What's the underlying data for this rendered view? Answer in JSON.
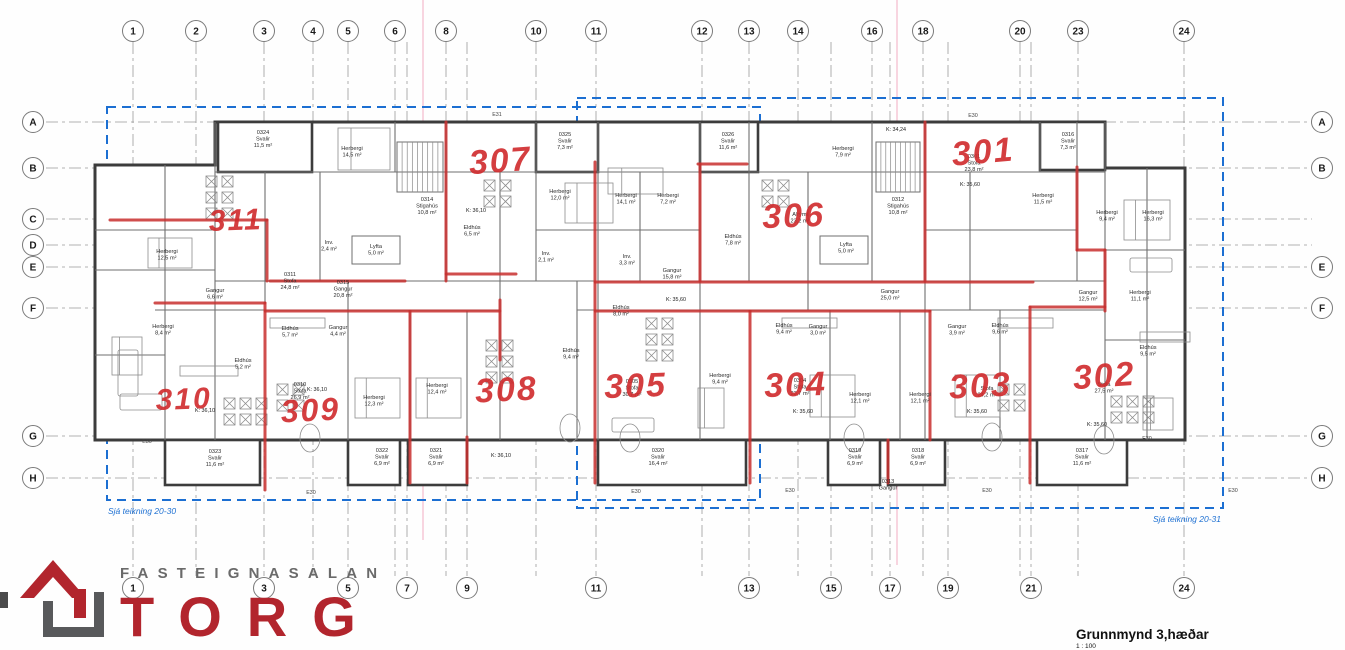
{
  "title_block": {
    "title": "Grunnmynd 3,hæðar",
    "scale": "1 : 100"
  },
  "logo": {
    "word_top": "FASTEIGNASALAN",
    "word_main": "TORG",
    "accent_color": "#b2252d",
    "gray_color": "#58595b"
  },
  "annotations": {
    "left_note": "Sjá teikning 20-30",
    "right_note": "Sjá teikning 20-31",
    "blue_color": "#1c6fd2",
    "rects": [
      {
        "x": 107,
        "y": 107,
        "w": 653,
        "h": 393
      },
      {
        "x": 577,
        "y": 98,
        "w": 646,
        "h": 410
      }
    ]
  },
  "grid": {
    "columns": [
      {
        "x": 133,
        "top": "1",
        "bottom": "1"
      },
      {
        "x": 196,
        "top": "2"
      },
      {
        "x": 264,
        "top": "3",
        "bottom": "3"
      },
      {
        "x": 313,
        "top": "4"
      },
      {
        "x": 348,
        "top": "5",
        "bottom": "5"
      },
      {
        "x": 395,
        "top": "6"
      },
      {
        "x": 407,
        "bottom": "7"
      },
      {
        "x": 446,
        "top": "8"
      },
      {
        "x": 467,
        "bottom": "9"
      },
      {
        "x": 536,
        "top": "10"
      },
      {
        "x": 596,
        "top": "11",
        "bottom": "11"
      },
      {
        "x": 702,
        "top": "12"
      },
      {
        "x": 749,
        "top": "13",
        "bottom": "13"
      },
      {
        "x": 798,
        "top": "14"
      },
      {
        "x": 831,
        "bottom": "15"
      },
      {
        "x": 872,
        "top": "16"
      },
      {
        "x": 890,
        "bottom": "17"
      },
      {
        "x": 923,
        "top": "18"
      },
      {
        "x": 948,
        "bottom": "19"
      },
      {
        "x": 1020,
        "top": "20"
      },
      {
        "x": 1031,
        "bottom": "21"
      },
      {
        "x": 1078,
        "top": "23"
      },
      {
        "x": 1184,
        "top": "24",
        "bottom": "24"
      }
    ],
    "rows": [
      {
        "y": 122,
        "left": "A",
        "right": "A"
      },
      {
        "y": 168,
        "left": "B",
        "right": "B"
      },
      {
        "y": 219,
        "left": "C"
      },
      {
        "y": 245,
        "left": "D"
      },
      {
        "y": 267,
        "left": "E",
        "right": "E"
      },
      {
        "y": 308,
        "left": "F",
        "right": "F"
      },
      {
        "y": 436,
        "left": "G",
        "right": "G"
      },
      {
        "y": 478,
        "left": "H",
        "right": "H"
      }
    ]
  },
  "apartments": [
    {
      "number": "311",
      "x": 236,
      "y": 230,
      "size": 30,
      "rot": -2
    },
    {
      "number": "307",
      "x": 501,
      "y": 172,
      "size": 34,
      "rot": -4
    },
    {
      "number": "301",
      "x": 984,
      "y": 163,
      "size": 34,
      "rot": -5
    },
    {
      "number": "306",
      "x": 794,
      "y": 227,
      "size": 34,
      "rot": -2
    },
    {
      "number": "310",
      "x": 184,
      "y": 409,
      "size": 30,
      "rot": -2
    },
    {
      "number": "309",
      "x": 311,
      "y": 421,
      "size": 32,
      "rot": -3
    },
    {
      "number": "308",
      "x": 507,
      "y": 401,
      "size": 34,
      "rot": -3
    },
    {
      "number": "305",
      "x": 636,
      "y": 397,
      "size": 34,
      "rot": -2
    },
    {
      "number": "304",
      "x": 796,
      "y": 396,
      "size": 34,
      "rot": -2
    },
    {
      "number": "303",
      "x": 981,
      "y": 397,
      "size": 34,
      "rot": -3
    },
    {
      "number": "302",
      "x": 1105,
      "y": 387,
      "size": 34,
      "rot": -4
    }
  ],
  "room_labels": [
    {
      "t": "0324\nSvalir\n11,5 m²",
      "x": 263,
      "y": 134
    },
    {
      "t": "Herbergi\n14,5 m²",
      "x": 352,
      "y": 150
    },
    {
      "t": "0325\nSvalir\n7,3 m²",
      "x": 565,
      "y": 136
    },
    {
      "t": "0326\nSvalir\n11,6 m²",
      "x": 728,
      "y": 136
    },
    {
      "t": "0316\nSvalir\n7,3 m²",
      "x": 1068,
      "y": 136
    },
    {
      "t": "Herbergi\n12,0 m²",
      "x": 560,
      "y": 193
    },
    {
      "t": "Herbergi\n14,1 m²",
      "x": 626,
      "y": 197
    },
    {
      "t": "Herbergi\n7,2 m²",
      "x": 668,
      "y": 197
    },
    {
      "t": "Herbergi\n7,9 m²",
      "x": 843,
      "y": 150
    },
    {
      "t": "0311\nStofa\n24,8 m²",
      "x": 290,
      "y": 276
    },
    {
      "t": "Herbergi\n12,5 m²",
      "x": 167,
      "y": 253
    },
    {
      "t": "0314\nStigahús\n10,8 m²",
      "x": 427,
      "y": 201
    },
    {
      "t": "0312\nStigahús\n10,8 m²",
      "x": 898,
      "y": 201
    },
    {
      "t": "Inv.\n2,4 m²",
      "x": 329,
      "y": 244
    },
    {
      "t": "Inv.\n2,1 m²",
      "x": 546,
      "y": 255
    },
    {
      "t": "Lyfta\n5,0 m²",
      "x": 376,
      "y": 248
    },
    {
      "t": "Lyfta\n5,0 m²",
      "x": 846,
      "y": 246
    },
    {
      "t": "0315\nGangur\n20,8 m²",
      "x": 343,
      "y": 284
    },
    {
      "t": "Gangur\n15,8 m²",
      "x": 672,
      "y": 272
    },
    {
      "t": "Inv.\n3,3 m²",
      "x": 627,
      "y": 258
    },
    {
      "t": "Eldhús\n8,0 m²",
      "x": 621,
      "y": 309
    },
    {
      "t": "Eldhús\n6,5 m²",
      "x": 472,
      "y": 229
    },
    {
      "t": "Alrými\n23,2 m²",
      "x": 800,
      "y": 216
    },
    {
      "t": "Eldhús\n7,8 m²",
      "x": 733,
      "y": 238
    },
    {
      "t": "0301\nStofa\n23,8 m²",
      "x": 974,
      "y": 158
    },
    {
      "t": "Herbergi\n11,5 m²",
      "x": 1043,
      "y": 197
    },
    {
      "t": "Herbergi\n9,4 m²",
      "x": 1107,
      "y": 214
    },
    {
      "t": "Herbergi\n16,3 m²",
      "x": 1153,
      "y": 214
    },
    {
      "t": "Gangur\n12,5 m²",
      "x": 1088,
      "y": 294
    },
    {
      "t": "Herbergi\n11,1 m²",
      "x": 1140,
      "y": 294
    },
    {
      "t": "Eldhús\n9,5 m²",
      "x": 1148,
      "y": 349
    },
    {
      "t": "Stofa\n27,5 m²",
      "x": 1104,
      "y": 386
    },
    {
      "t": "0317\nSvalir\n11,6 m²",
      "x": 1082,
      "y": 452
    },
    {
      "t": "Herbergi\n8,4 m²",
      "x": 163,
      "y": 328
    },
    {
      "t": "Gangur\n6,6 m²",
      "x": 215,
      "y": 292
    },
    {
      "t": "Eldhús\n5,2 m²",
      "x": 243,
      "y": 362
    },
    {
      "t": "0310\nStofa\n26,9 m²",
      "x": 300,
      "y": 386
    },
    {
      "t": "0323\nSvalir\n11,6 m²",
      "x": 215,
      "y": 453
    },
    {
      "t": "Eldhús\n5,7 m²",
      "x": 290,
      "y": 330
    },
    {
      "t": "Gangur\n4,4 m²",
      "x": 338,
      "y": 329
    },
    {
      "t": "Herbergi\n12,3 m²",
      "x": 374,
      "y": 399
    },
    {
      "t": "Herbergi\n12,4 m²",
      "x": 437,
      "y": 387
    },
    {
      "t": "0322\nSvalir\n6,9 m²",
      "x": 382,
      "y": 452
    },
    {
      "t": "0321\nSvalir\n6,9 m²",
      "x": 436,
      "y": 452
    },
    {
      "t": "Eldhús\n9,4 m²",
      "x": 571,
      "y": 352
    },
    {
      "t": "Eldhús\n9,4 m²",
      "x": 784,
      "y": 327
    },
    {
      "t": "Eldhús\n9,6 m²",
      "x": 1000,
      "y": 327
    },
    {
      "t": "Gangur\n3,0 m²",
      "x": 818,
      "y": 328
    },
    {
      "t": "Gangur\n3,9 m²",
      "x": 957,
      "y": 328
    },
    {
      "t": "Herbergi\n12,1 m²",
      "x": 860,
      "y": 396
    },
    {
      "t": "Herbergi\n12,1 m²",
      "x": 920,
      "y": 396
    },
    {
      "t": "0304\nStofa\n23,7 m²",
      "x": 800,
      "y": 382
    },
    {
      "t": "Stofa\n24,2 m²",
      "x": 987,
      "y": 390
    },
    {
      "t": "0305\nStofa\n30,7 m²",
      "x": 632,
      "y": 383
    },
    {
      "t": "Herbergi\n9,4 m²",
      "x": 720,
      "y": 377
    },
    {
      "t": "0320\nSvalir\n16,4 m²",
      "x": 658,
      "y": 452
    },
    {
      "t": "0319\nSvalir\n6,9 m²",
      "x": 855,
      "y": 452
    },
    {
      "t": "0318\nSvalir\n6,9 m²",
      "x": 918,
      "y": 452
    },
    {
      "t": "Gangur\n25,0 m²",
      "x": 890,
      "y": 293
    },
    {
      "t": "0313\nGangur",
      "x": 888,
      "y": 483
    }
  ],
  "k_marks": [
    {
      "t": "K: 36,10",
      "x": 476,
      "y": 212
    },
    {
      "t": "K: 34,24",
      "x": 896,
      "y": 131
    },
    {
      "t": "K: 35,60",
      "x": 970,
      "y": 186
    },
    {
      "t": "K: 35,60",
      "x": 676,
      "y": 301
    },
    {
      "t": "K: 35,60",
      "x": 803,
      "y": 413
    },
    {
      "t": "K: 35,60",
      "x": 977,
      "y": 413
    },
    {
      "t": "K: 35,60",
      "x": 1097,
      "y": 426
    },
    {
      "t": "K: 36,10",
      "x": 205,
      "y": 412
    },
    {
      "t": "K: 36,10",
      "x": 317,
      "y": 391
    },
    {
      "t": "K: 36,10",
      "x": 501,
      "y": 457
    }
  ],
  "e_marks": [
    {
      "t": "E31",
      "x": 497,
      "y": 116
    },
    {
      "t": "E30",
      "x": 973,
      "y": 117
    },
    {
      "t": "E30",
      "x": 147,
      "y": 443
    },
    {
      "t": "E30",
      "x": 311,
      "y": 494
    },
    {
      "t": "E30",
      "x": 636,
      "y": 493
    },
    {
      "t": "E30",
      "x": 790,
      "y": 492
    },
    {
      "t": "E30",
      "x": 987,
      "y": 492
    },
    {
      "t": "E30",
      "x": 1147,
      "y": 440
    },
    {
      "t": "E30",
      "x": 1233,
      "y": 492
    }
  ],
  "plan_geometry": {
    "outer": "M95,165 L215,165 L215,122 L1105,122 L1105,168 L1185,168 L1185,440 L95,440 Z",
    "balconies_top": [
      [
        218,
        122,
        94,
        50
      ],
      [
        536,
        122,
        62,
        50
      ],
      [
        700,
        122,
        58,
        50
      ],
      [
        1040,
        122,
        65,
        48
      ]
    ],
    "balconies_bottom": [
      [
        165,
        95
      ],
      [
        348,
        52
      ],
      [
        408,
        59
      ],
      [
        598,
        148
      ],
      [
        828,
        52
      ],
      [
        888,
        57
      ],
      [
        1037,
        90
      ]
    ],
    "inner_v": [
      [
        165,
        165,
        440
      ],
      [
        215,
        122,
        440
      ],
      [
        265,
        172,
        303
      ],
      [
        320,
        172,
        281
      ],
      [
        348,
        281,
        440
      ],
      [
        395,
        122,
        172
      ],
      [
        410,
        311,
        440
      ],
      [
        446,
        122,
        281
      ],
      [
        467,
        311,
        440
      ],
      [
        500,
        172,
        440
      ],
      [
        536,
        122,
        281
      ],
      [
        577,
        281,
        440
      ],
      [
        598,
        122,
        440
      ],
      [
        640,
        172,
        281
      ],
      [
        700,
        122,
        440
      ],
      [
        749,
        122,
        281
      ],
      [
        808,
        172,
        310
      ],
      [
        830,
        310,
        440
      ],
      [
        872,
        122,
        281
      ],
      [
        900,
        310,
        440
      ],
      [
        925,
        122,
        440
      ],
      [
        970,
        172,
        310
      ],
      [
        1000,
        310,
        440
      ],
      [
        1040,
        122,
        172
      ],
      [
        1077,
        122,
        281
      ],
      [
        1105,
        122,
        440
      ],
      [
        1147,
        168,
        440
      ]
    ],
    "inner_h": [
      [
        172,
        215,
        1105
      ],
      [
        230,
        95,
        215
      ],
      [
        230,
        536,
        700
      ],
      [
        230,
        925,
        1077
      ],
      [
        270,
        95,
        215
      ],
      [
        281,
        215,
        595
      ],
      [
        281,
        598,
        925
      ],
      [
        281,
        925,
        1105
      ],
      [
        310,
        155,
        500
      ],
      [
        310,
        577,
        1105
      ],
      [
        355,
        95,
        165
      ],
      [
        250,
        1105,
        1185
      ],
      [
        340,
        1105,
        1185
      ]
    ],
    "stairs": [
      [
        397,
        142,
        46,
        50
      ],
      [
        876,
        142,
        44,
        50
      ]
    ],
    "elevators": [
      [
        352,
        236,
        48,
        28
      ],
      [
        820,
        236,
        48,
        28
      ]
    ],
    "red_h": [
      [
        220,
        110,
        267
      ],
      [
        281,
        270,
        405
      ],
      [
        274,
        446,
        516
      ],
      [
        282,
        595,
        1033
      ],
      [
        303,
        155,
        265
      ],
      [
        311,
        265,
        500
      ],
      [
        311,
        595,
        750
      ],
      [
        311,
        750,
        930
      ],
      [
        307,
        1030,
        1105
      ],
      [
        164,
        698,
        747
      ],
      [
        250,
        1077,
        1105
      ]
    ],
    "red_v": [
      [
        267,
        220,
        281
      ],
      [
        446,
        122,
        281
      ],
      [
        595,
        162,
        483
      ],
      [
        700,
        164,
        281
      ],
      [
        925,
        122,
        281
      ],
      [
        1077,
        167,
        250
      ],
      [
        265,
        303,
        490
      ],
      [
        410,
        311,
        483
      ],
      [
        467,
        437,
        483
      ],
      [
        500,
        300,
        360
      ],
      [
        750,
        311,
        483
      ],
      [
        888,
        440,
        483
      ],
      [
        930,
        311,
        440
      ],
      [
        1030,
        307,
        483
      ],
      [
        1105,
        250,
        311
      ]
    ],
    "beds": [
      [
        148,
        238,
        44,
        30
      ],
      [
        338,
        128,
        52,
        42
      ],
      [
        565,
        183,
        48,
        40
      ],
      [
        608,
        168,
        55,
        26
      ],
      [
        1124,
        200,
        46,
        40
      ],
      [
        1143,
        398,
        30,
        32
      ],
      [
        355,
        378,
        45,
        40
      ],
      [
        416,
        378,
        45,
        40
      ],
      [
        810,
        375,
        45,
        42
      ],
      [
        955,
        375,
        45,
        42
      ],
      [
        112,
        337,
        30,
        38
      ],
      [
        698,
        388,
        26,
        40
      ]
    ],
    "tables": [
      [
        206,
        176,
        2,
        3
      ],
      [
        484,
        180,
        2,
        2
      ],
      [
        762,
        180,
        2,
        2
      ],
      [
        224,
        398,
        3,
        2
      ],
      [
        277,
        384,
        2,
        2
      ],
      [
        486,
        340,
        2,
        3
      ],
      [
        998,
        384,
        2,
        2
      ],
      [
        1111,
        396,
        3,
        2
      ],
      [
        646,
        318,
        2,
        3
      ]
    ],
    "ovals": [
      [
        310,
        438
      ],
      [
        630,
        438
      ],
      [
        854,
        438
      ],
      [
        992,
        437
      ],
      [
        1104,
        440
      ],
      [
        570,
        428
      ]
    ],
    "sofas": [
      [
        118,
        350,
        20,
        46
      ],
      [
        120,
        394,
        42,
        16
      ],
      [
        612,
        418,
        42,
        14
      ],
      [
        1130,
        258,
        42,
        14
      ]
    ],
    "counters": [
      [
        270,
        318,
        55,
        10
      ],
      [
        782,
        318,
        55,
        10
      ],
      [
        998,
        318,
        55,
        10
      ],
      [
        1140,
        332,
        50,
        10
      ],
      [
        180,
        366,
        58,
        10
      ]
    ],
    "artifact_lines": [
      {
        "x": 423,
        "y1": 0,
        "y2": 540
      },
      {
        "x": 897,
        "y1": 0,
        "y2": 565
      }
    ],
    "wall_color": "#3c3c3c",
    "thin_color": "#6f6f6f",
    "red_color": "#c8302f",
    "grid_color": "#9a9a9a"
  }
}
